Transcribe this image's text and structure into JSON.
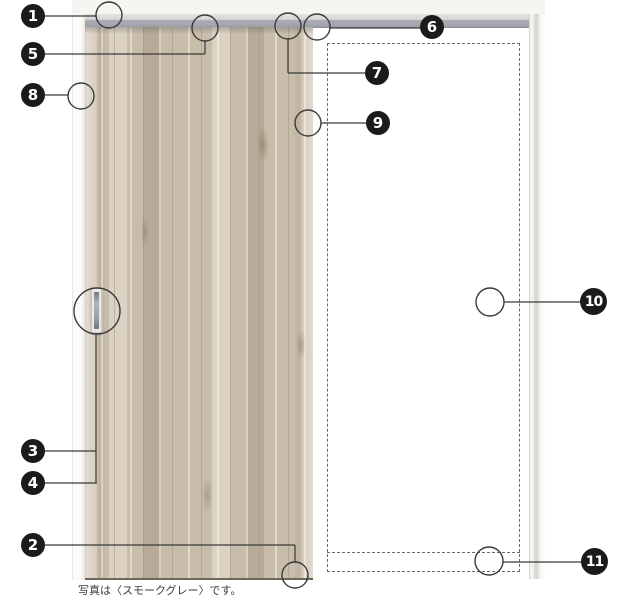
{
  "diagram": {
    "caption": "写真は〈スモークグレー〉です。",
    "callouts": {
      "c1": "1",
      "c2": "2",
      "c3": "3",
      "c4": "4",
      "c5": "5",
      "c6": "6",
      "c7": "7",
      "c8": "8",
      "c9": "9",
      "c10": "10",
      "c11": "11"
    },
    "colors": {
      "marker_black": "#1b1b1b",
      "wood_base": "#c8bcab",
      "rail_gray": "#a9adb3",
      "leader_line": "#3a3a3a",
      "dashed_outline": "#6a6a6a"
    }
  }
}
